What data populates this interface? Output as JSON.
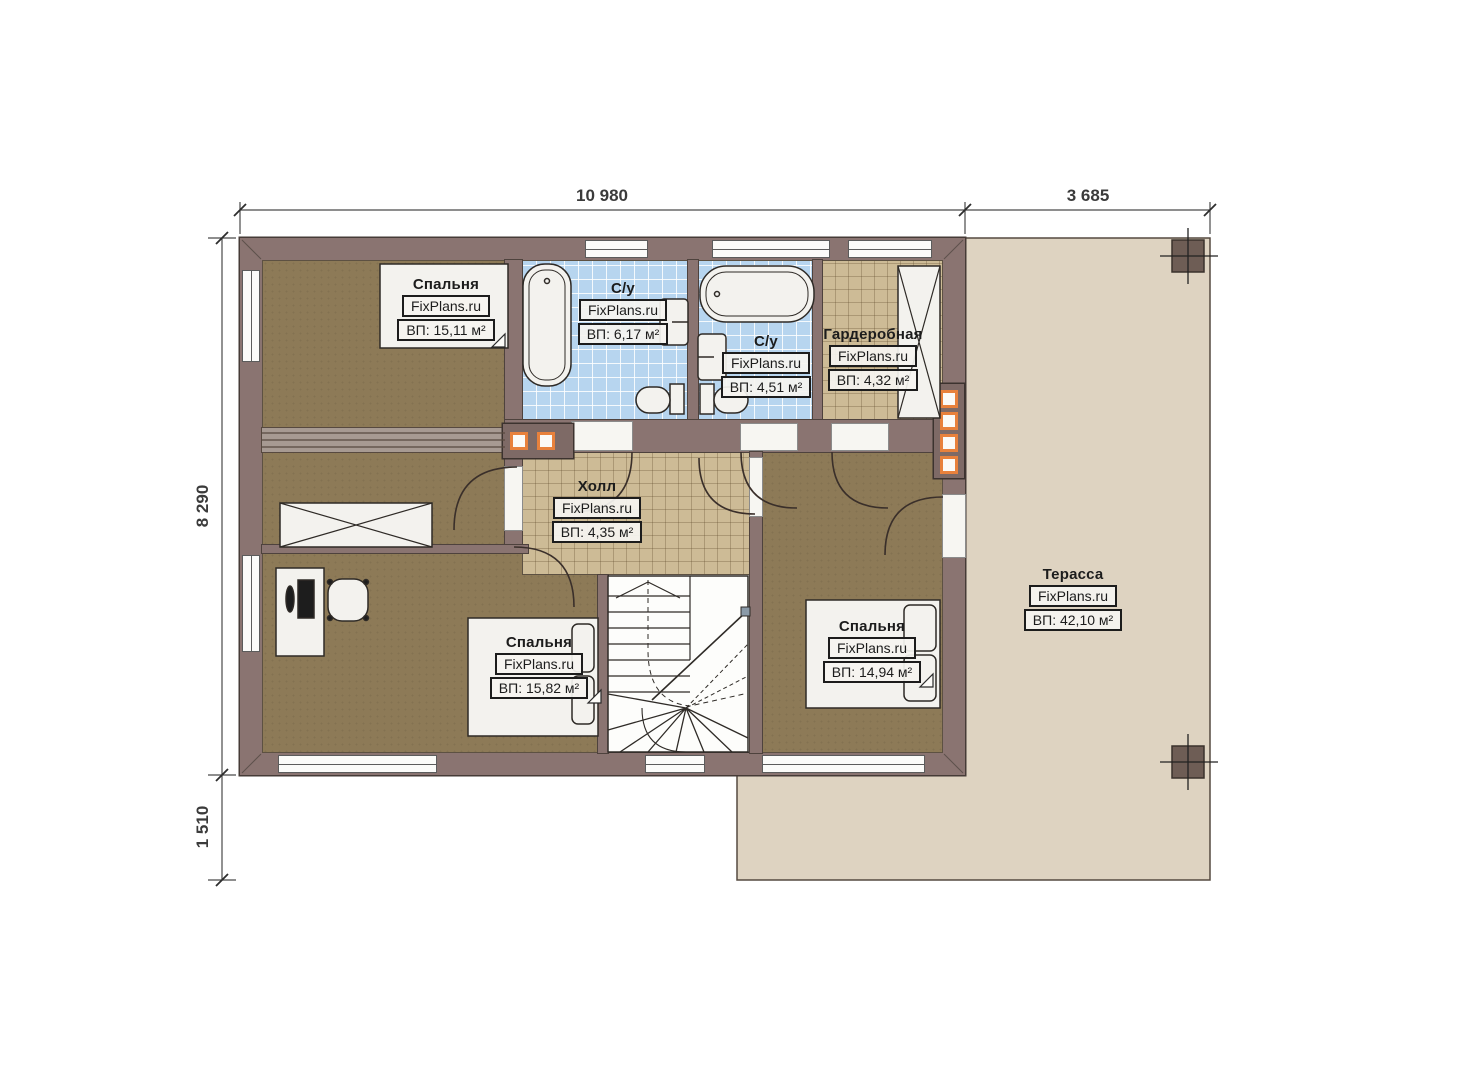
{
  "plan": {
    "brand": "FixPlans.ru",
    "dimensions": {
      "top_main": "10 980",
      "top_right": "3 685",
      "left_main": "8 290",
      "left_lower": "1 510"
    },
    "rooms": [
      {
        "name": "Спальня",
        "brand": "FixPlans.ru",
        "area": "ВП: 15,11 м²"
      },
      {
        "name": "С/у",
        "brand": "FixPlans.ru",
        "area": "ВП: 6,17 м²"
      },
      {
        "name": "С/у",
        "brand": "FixPlans.ru",
        "area": "ВП: 4,51 м²"
      },
      {
        "name": "Гардеробная",
        "brand": "FixPlans.ru",
        "area": "ВП: 4,32 м²"
      },
      {
        "name": "Холл",
        "brand": "FixPlans.ru",
        "area": "ВП: 4,35 м²"
      },
      {
        "name": "Спальня",
        "brand": "FixPlans.ru",
        "area": "ВП: 15,82 м²"
      },
      {
        "name": "Спальня",
        "brand": "FixPlans.ru",
        "area": "ВП: 14,94 м²"
      },
      {
        "name": "Терасса",
        "brand": "FixPlans.ru",
        "area": "ВП: 42,10 м²"
      }
    ],
    "colors": {
      "wall": "#8a7471",
      "floor_wood": "#8d7a57",
      "tile_blue": "#b7d5ef",
      "tile_tan": "#cdbb96",
      "terrace": "#ded3c1",
      "accent_orange": "#e8813c"
    }
  }
}
